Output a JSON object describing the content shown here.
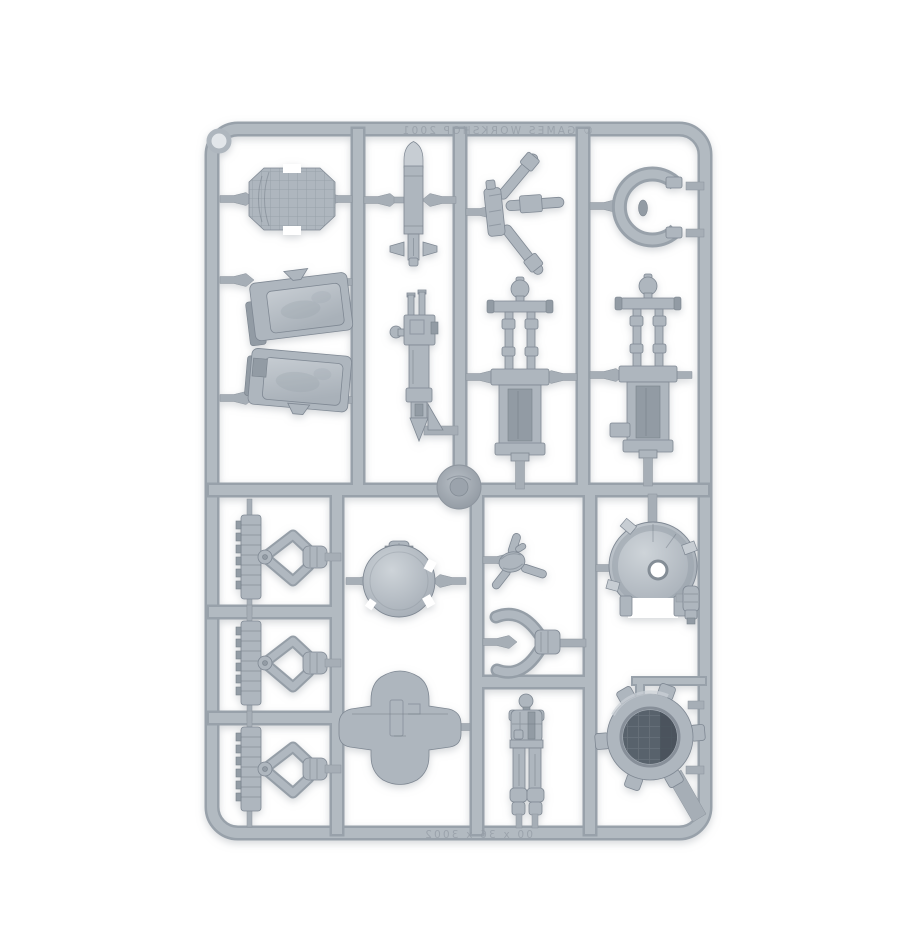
{
  "scene": {
    "type": "product-photo",
    "subject": "Grey plastic model-kit sprue (injection-moulded frame) holding miniature vehicle and crew parts, photographed on a plain white background",
    "background_color": "#ffffff"
  },
  "colors": {
    "plastic_base": "#aeb6be",
    "plastic_light": "#c7cdd3",
    "plastic_mid": "#929ba4",
    "plastic_dark": "#7f8893",
    "recess_dark": "#59626c",
    "soft_shadow": "#aab0b6"
  },
  "embossed": {
    "top_text": "© GAMES WORKSHOP 2001",
    "bottom_text": "00 x 36 x 3002",
    "style": "faint mirrored raised lettering moulded into the sprue rails"
  },
  "frame": {
    "shape": "rounded rectangle with internal runner grid",
    "corner_mark": "moulded locator ring, top-left corner"
  },
  "parts": [
    {
      "id": "tread-plate",
      "label": "textured tread plate with notches",
      "center": [
        292,
        199
      ]
    },
    {
      "id": "missile",
      "label": "missile / bomb with tail fins",
      "center": [
        413,
        200
      ]
    },
    {
      "id": "tripod-arms",
      "label": "three-pronged antenna / leg assembly",
      "center": [
        512,
        212
      ]
    },
    {
      "id": "c-ring",
      "label": "open C-ring collar",
      "center": [
        650,
        206
      ]
    },
    {
      "id": "hatch-panel-upper",
      "label": "angled hatch panel (upper)",
      "center": [
        297,
        305
      ]
    },
    {
      "id": "hatch-panel-lower",
      "label": "angled hatch panel (lower)",
      "center": [
        297,
        378
      ]
    },
    {
      "id": "gun",
      "label": "long gun / weapon",
      "center": [
        420,
        365
      ]
    },
    {
      "id": "strut-left",
      "label": "twin-rod piston strut assembly (left)",
      "center": [
        520,
        380
      ]
    },
    {
      "id": "strut-right",
      "label": "twin-rod piston strut assembly (right)",
      "center": [
        648,
        378
      ]
    },
    {
      "id": "injection-hub",
      "label": "central round injection hub",
      "center": [
        459,
        487
      ]
    },
    {
      "id": "claw-arm-1",
      "label": "mechanical claw arm on ridged rail",
      "center": [
        265,
        557
      ]
    },
    {
      "id": "claw-arm-2",
      "label": "mechanical claw arm on ridged rail",
      "center": [
        265,
        663
      ]
    },
    {
      "id": "claw-arm-3",
      "label": "mechanical claw arm on ridged rail",
      "center": [
        265,
        769
      ]
    },
    {
      "id": "round-hatch",
      "label": "round hatch with hinge tab",
      "center": [
        399,
        581
      ]
    },
    {
      "id": "turbine-piece",
      "label": "small rotor / turbine piece",
      "center": [
        512,
        562
      ]
    },
    {
      "id": "pincer-claw",
      "label": "two-jaw gripper claw",
      "center": [
        520,
        643
      ]
    },
    {
      "id": "large-dome",
      "label": "large dome with centre hole",
      "center": [
        653,
        566
      ]
    },
    {
      "id": "shield-plate",
      "label": "shield / breastplate cross piece",
      "center": [
        400,
        727
      ]
    },
    {
      "id": "trooper-body",
      "label": "standing trooper body (head, torso, legs)",
      "center": [
        526,
        757
      ]
    },
    {
      "id": "lugged-ring",
      "label": "lugged ring hatch collar, dark mesh interior",
      "center": [
        650,
        737
      ]
    }
  ]
}
